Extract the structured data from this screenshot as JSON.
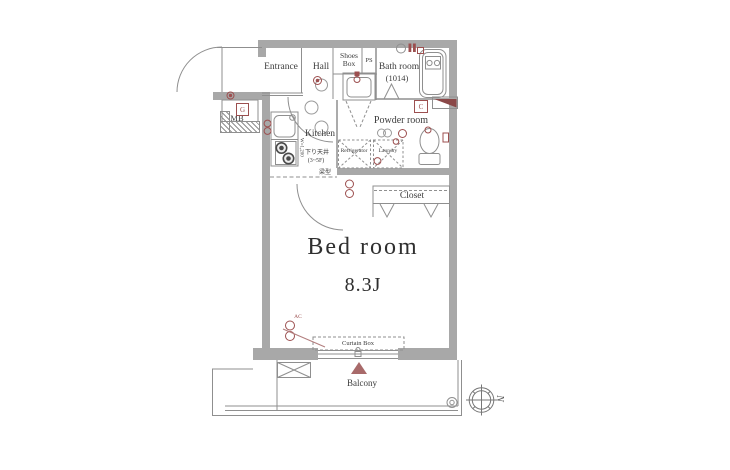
{
  "rooms": {
    "entrance": {
      "label": "Entrance"
    },
    "hall": {
      "label": "Hall"
    },
    "shoes_box": {
      "label": "Shoes Box"
    },
    "ps": {
      "label": "PS"
    },
    "bath_room": {
      "label": "Bath room",
      "size": "(1014)"
    },
    "powder_room": {
      "label": "Powder room"
    },
    "kitchen": {
      "label": "Kitchen"
    },
    "refrigerator": {
      "label": "Refrigerator"
    },
    "laundry": {
      "label": "Laundry"
    },
    "closet": {
      "label": "Closet"
    },
    "bed_room": {
      "label": "Bed room",
      "size": "8.3J"
    },
    "balcony": {
      "label": "Balcony"
    },
    "curtain_box": {
      "label": "Curtain Box"
    },
    "meter_box": {
      "label": "MB"
    }
  },
  "annotations": {
    "lowered_ceiling_line1": "下り天井",
    "lowered_ceiling_line2": "(3~5F)",
    "beam": "梁型",
    "kitchen_width": "W=1,200",
    "ac": "AC",
    "gas_meter": "G",
    "c_mark": "C",
    "north": "N"
  },
  "colors": {
    "wall": "#a8a8a8",
    "line": "#8f8f8f",
    "accent": "#9c4f4f",
    "accent_dark": "#8a4848",
    "text": "#3c3c3c"
  }
}
